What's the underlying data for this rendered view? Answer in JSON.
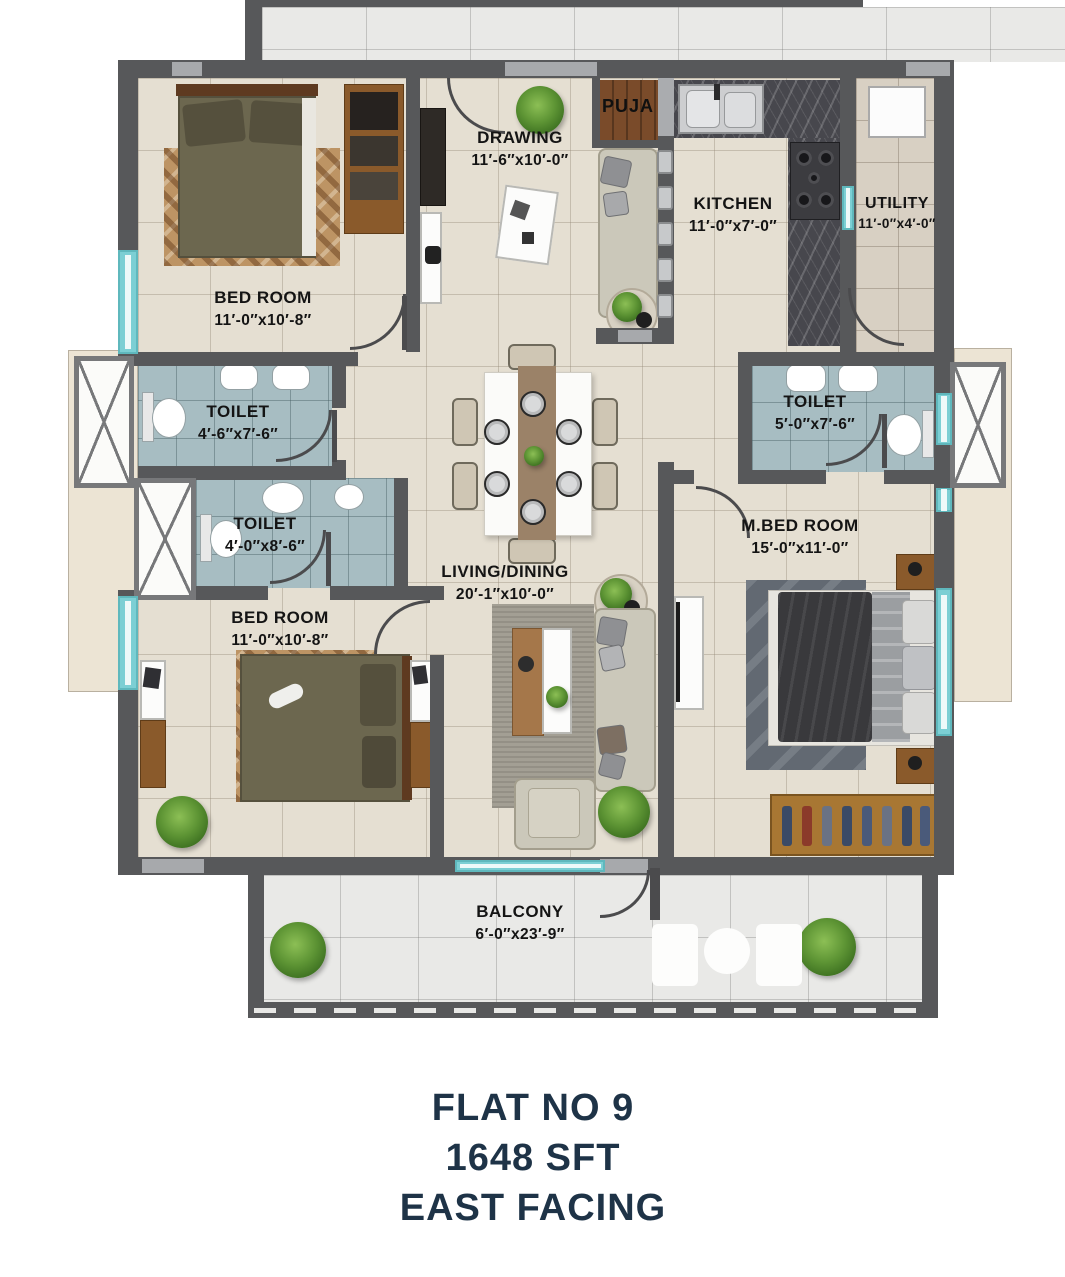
{
  "rooms": {
    "bedroomTop": {
      "name": "BED ROOM",
      "dims": "11′-0″x10′-8″"
    },
    "drawing": {
      "name": "DRAWING",
      "dims": "11′-6″x10′-0″"
    },
    "puja": {
      "name": "PUJA"
    },
    "kitchen": {
      "name": "KITCHEN",
      "dims": "11′-0″x7′-0″"
    },
    "utility": {
      "name": "UTILITY",
      "dims": "11′-0″x4′-0″"
    },
    "toiletTopLeft": {
      "name": "TOILET",
      "dims": "4′-6″x7′-6″"
    },
    "toiletMidLeft": {
      "name": "TOILET",
      "dims": "4′-0″x8′-6″"
    },
    "toiletRight": {
      "name": "TOILET",
      "dims": "5′-0″x7′-6″"
    },
    "living": {
      "name": "LIVING/DINING",
      "dims": "20′-1″x10′-0″"
    },
    "bedroomBottom": {
      "name": "BED ROOM",
      "dims": "11′-0″x10′-8″"
    },
    "masterBedroom": {
      "name": "M.BED ROOM",
      "dims": "15′-0″x11′-0″"
    },
    "balcony": {
      "name": "BALCONY",
      "dims": "6′-0″x23′-9″"
    }
  },
  "footer": {
    "line1": "FLAT NO 9",
    "line2": "1648 SFT",
    "line3": "EAST FACING"
  },
  "colors": {
    "wall": "#57585a",
    "wallLight": "#a7a9ac",
    "floor": "#e5dfd2",
    "toiletFloor": "#a7bdc2",
    "windowTeal": "#7ccfd4",
    "woodFloor": "#7a4b2a",
    "titleText": "#1e3347",
    "labelText": "#141414"
  }
}
